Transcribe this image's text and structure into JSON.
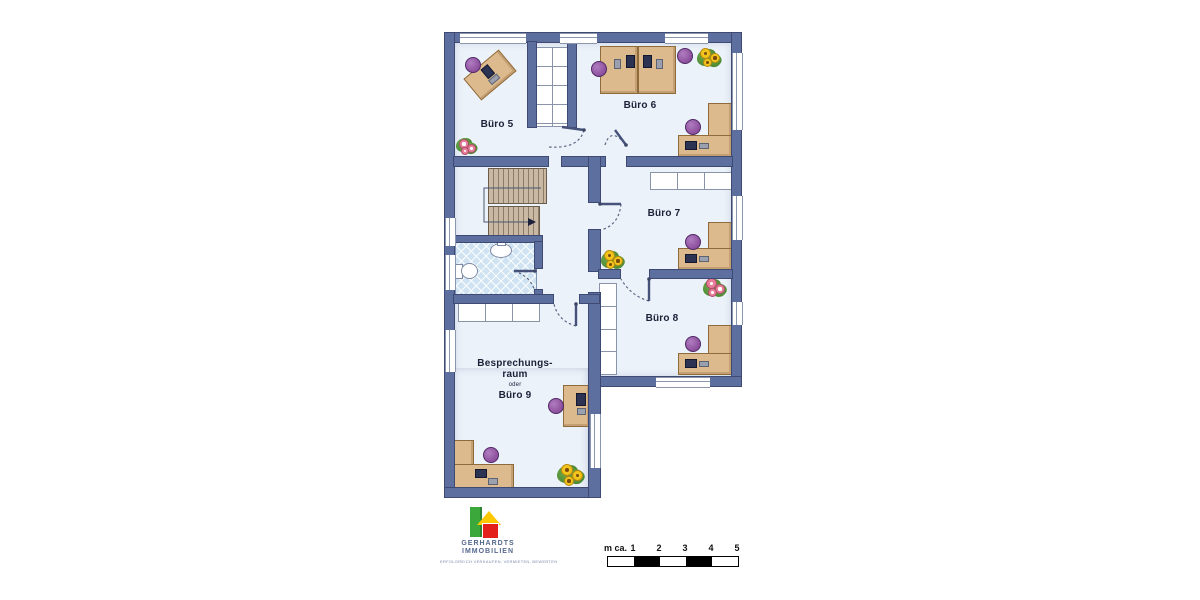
{
  "plan": {
    "rooms": [
      {
        "label": "Büro 5"
      },
      {
        "label": "Büro 6"
      },
      {
        "label": "Büro 7"
      },
      {
        "label": "Büro 8"
      },
      {
        "label_lines": [
          "Besprechungs-",
          "raum",
          "oder",
          "Büro 9"
        ]
      }
    ]
  },
  "branding": {
    "line1": "GERHARDTS",
    "line2": "IMMOBILIEN",
    "tagline": "ERFOLGREICH VERKAUFEN, VERMIETEN, BEWERTEN"
  },
  "scale_bar": {
    "prefix": "m ca.",
    "ticks": [
      "1",
      "2",
      "3",
      "4",
      "5"
    ]
  },
  "colors": {
    "wall": "#5d6f9e",
    "wall-edge": "#3e4a73",
    "floor": "#ecf2f9",
    "tile": "#cfe3f2",
    "stair": "#c9b9a4",
    "desk": "#dcba8d",
    "desk-edge": "#8f6b3c",
    "chair": "#8c4f9c",
    "label": "#1a2138",
    "logo-green": "#3aa83a",
    "logo-green-dark": "#2e8330",
    "logo-yellow": "#fdc800",
    "logo-red": "#e3211a",
    "brand-text": "#55688f"
  }
}
